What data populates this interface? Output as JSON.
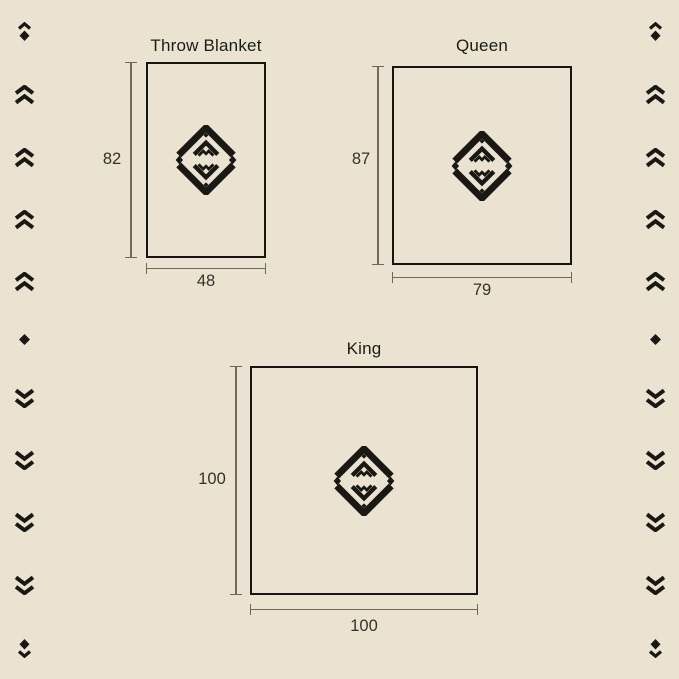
{
  "page": {
    "background_color": "#EBE3D2",
    "ink_color": "#1A1812",
    "outline_color": "#17150F",
    "dimension_line_color": "#6E695C"
  },
  "diagrams": {
    "throw": {
      "title": "Throw Blanket",
      "height_label": "82",
      "width_label": "48"
    },
    "queen": {
      "title": "Queen",
      "height_label": "87",
      "width_label": "79"
    },
    "king": {
      "title": "King",
      "height_label": "100",
      "width_label": "100"
    }
  },
  "side_decorations": {
    "left_sequence": [
      "chevron-diamond-up",
      "double-chevron-up",
      "double-chevron-up",
      "double-chevron-up",
      "double-chevron-up",
      "diamond",
      "double-chevron-down",
      "double-chevron-down",
      "double-chevron-down",
      "double-chevron-down",
      "diamond-chevron-down"
    ],
    "right_sequence": [
      "chevron-diamond-up",
      "double-chevron-up",
      "double-chevron-up",
      "double-chevron-up",
      "double-chevron-up",
      "diamond",
      "double-chevron-down",
      "double-chevron-down",
      "double-chevron-down",
      "double-chevron-down",
      "diamond-chevron-down"
    ]
  }
}
